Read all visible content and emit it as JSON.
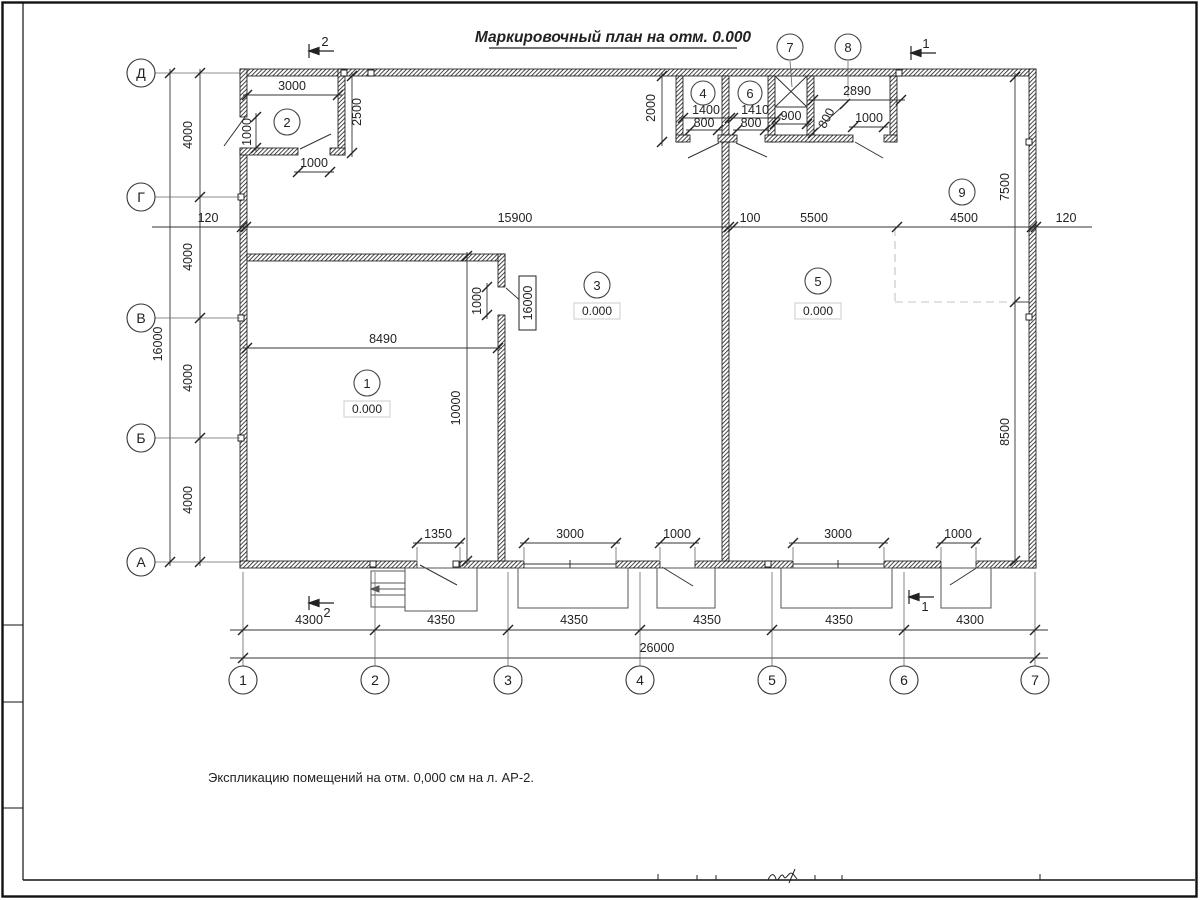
{
  "title": "Маркировочный план на отм. 0.000",
  "note": "Экспликацию помещений на отм. 0,000 см на л. АР-2.",
  "grid": {
    "rows": [
      "Д",
      "Г",
      "В",
      "Б",
      "А"
    ],
    "cols": [
      "1",
      "2",
      "3",
      "4",
      "5",
      "6",
      "7"
    ],
    "row_spacing": [
      "4000",
      "4000",
      "4000",
      "4000"
    ],
    "row_total": "16000",
    "col_spacing": [
      "4300",
      "4350",
      "4350",
      "4350",
      "4350",
      "4300"
    ],
    "col_total": "26000"
  },
  "dims": {
    "offset_left": "120",
    "span_main": "15900",
    "wall_gap": "100",
    "span_5500": "5500",
    "span_4500": "4500",
    "offset_right": "120",
    "room2_width": "3000",
    "room2_depth": "2500",
    "room2_door_left": "1000",
    "room2_door_bottom": "1000",
    "block_depth": "2000",
    "room4_width": "1400",
    "room6_width": "1410",
    "shaft_width": "900",
    "room4_door": "800",
    "room6_door": "800",
    "room8_width": "2890",
    "room8_door": "800",
    "corridor_door": "1000",
    "right_top": "7500",
    "right_bottom": "8500",
    "room1_width": "8490",
    "room1_depth": "10000",
    "room1_inner_door": "1000",
    "level_mark": "16000",
    "door1": "1350",
    "door2": "3000",
    "door3": "1000",
    "door4": "3000",
    "door5": "1000"
  },
  "rooms": [
    {
      "num": "1",
      "level": "0.000"
    },
    {
      "num": "2"
    },
    {
      "num": "3",
      "level": "0.000"
    },
    {
      "num": "4"
    },
    {
      "num": "5",
      "level": "0.000"
    },
    {
      "num": "6"
    },
    {
      "num": "7"
    },
    {
      "num": "8"
    },
    {
      "num": "9"
    }
  ],
  "sections": {
    "one": "1",
    "two": "2"
  }
}
